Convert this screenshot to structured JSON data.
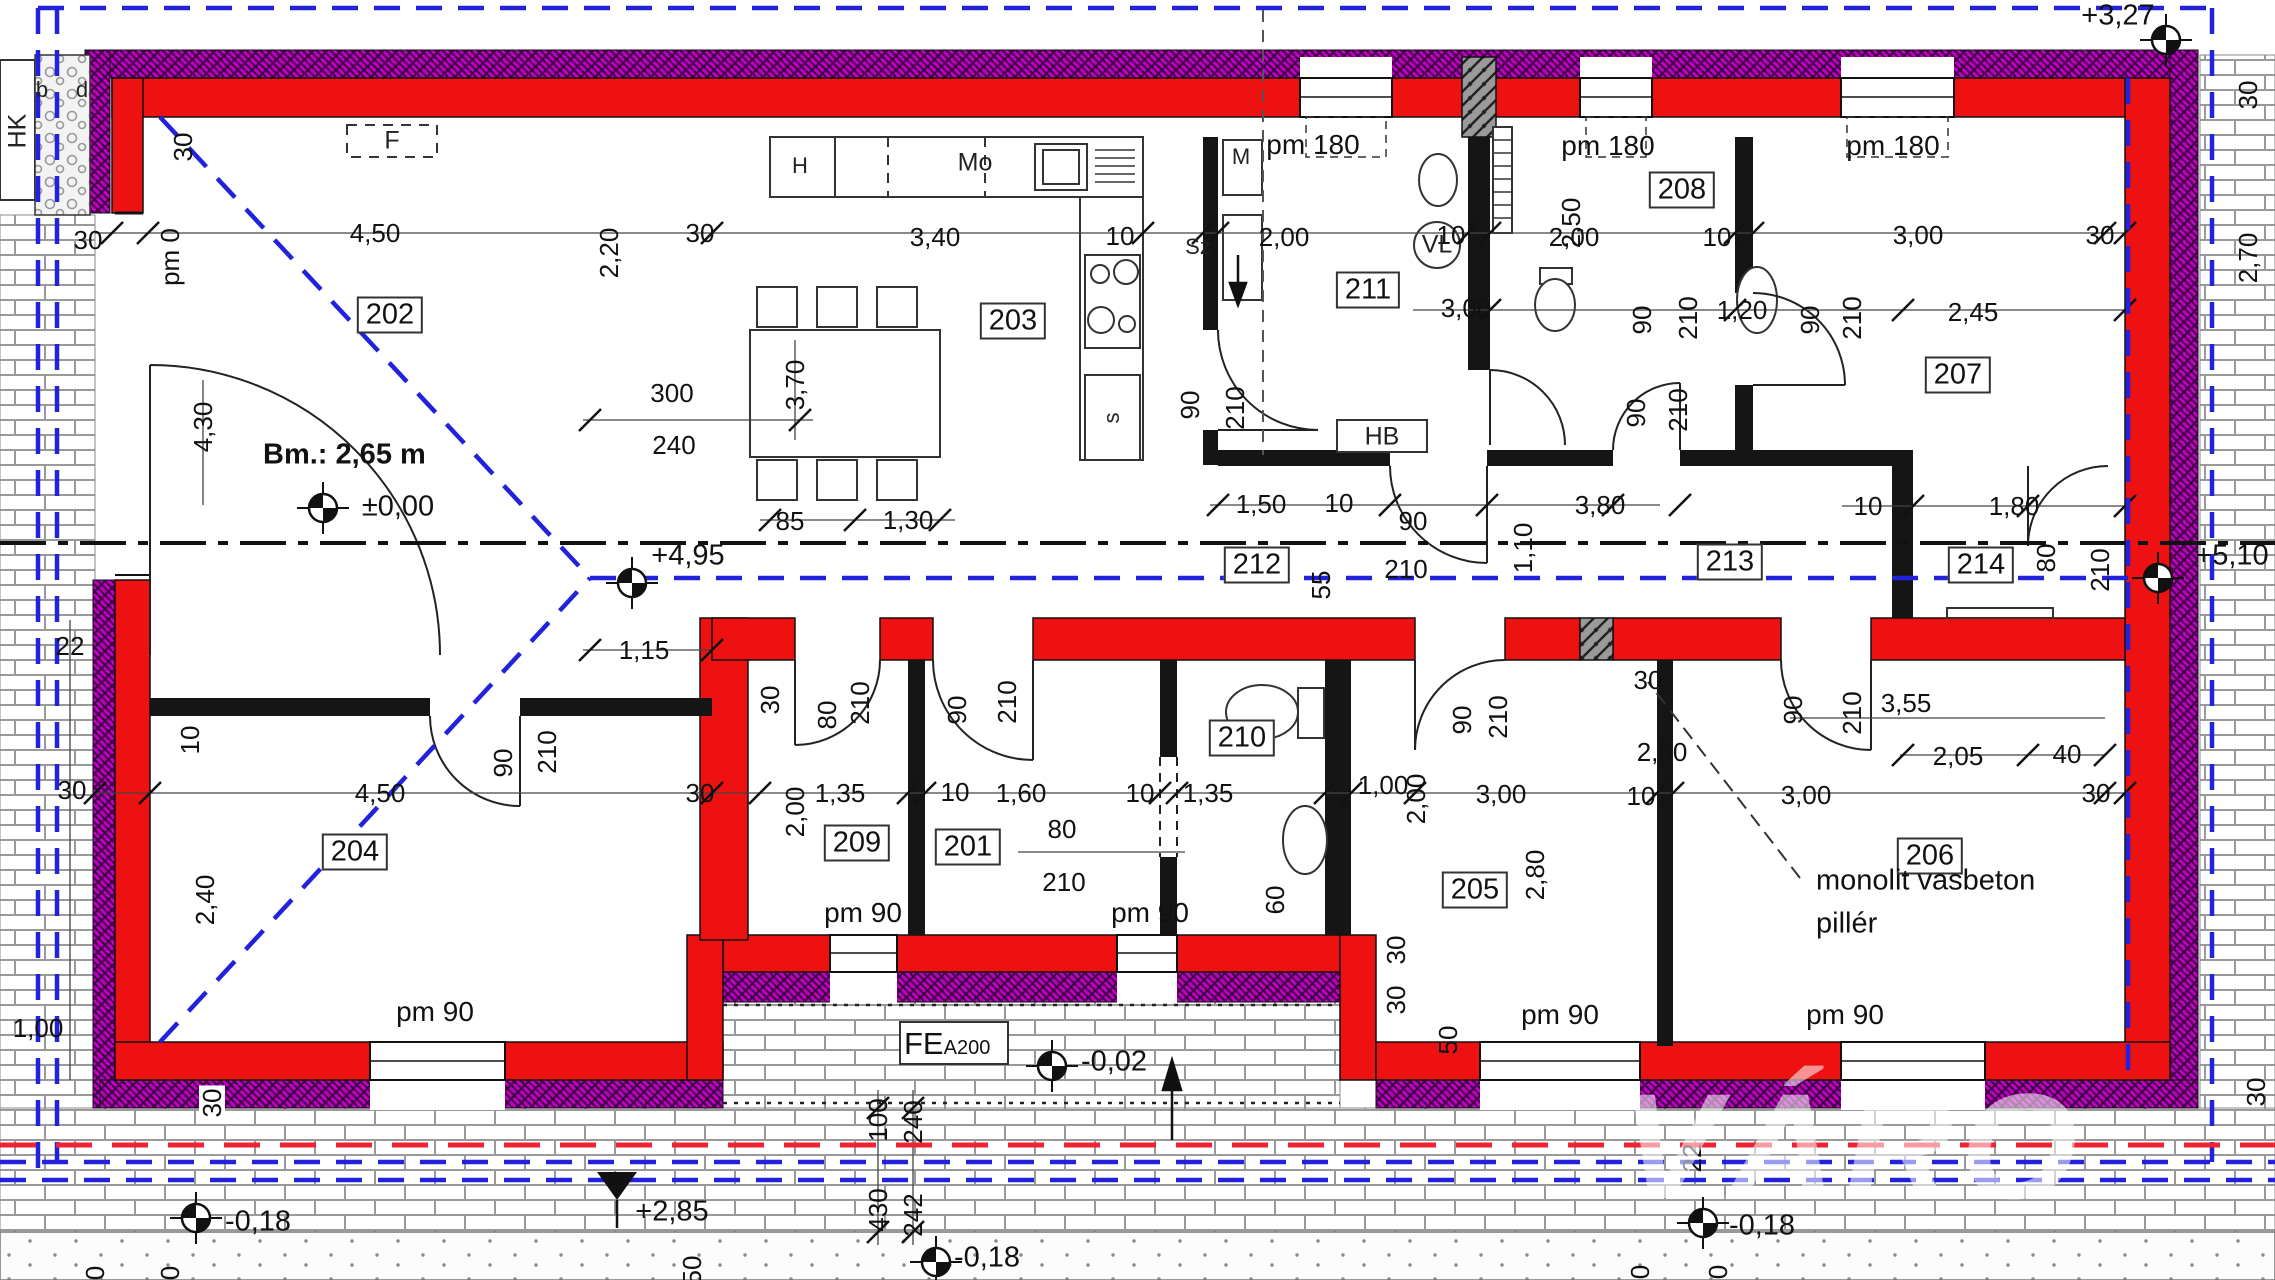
{
  "colors": {
    "wall_red": "#ee1111",
    "insulation_magenta": "#c000c4",
    "roof_line_blue": "#2222dd",
    "frost_line_red": "#ee2233",
    "pillar_grey": "#9a9a9a"
  },
  "rooms": [
    {
      "n": "202",
      "x": 390,
      "y": 315
    },
    {
      "n": "203",
      "x": 1013,
      "y": 321
    },
    {
      "n": "211",
      "x": 1368,
      "y": 290
    },
    {
      "n": "208",
      "x": 1682,
      "y": 190
    },
    {
      "n": "207",
      "x": 1958,
      "y": 375
    },
    {
      "n": "212",
      "x": 1257,
      "y": 565
    },
    {
      "n": "213",
      "x": 1730,
      "y": 562
    },
    {
      "n": "214",
      "x": 1981,
      "y": 565
    },
    {
      "n": "204",
      "x": 355,
      "y": 852
    },
    {
      "n": "209",
      "x": 857,
      "y": 843
    },
    {
      "n": "201",
      "x": 968,
      "y": 847
    },
    {
      "n": "210",
      "x": 1242,
      "y": 738
    },
    {
      "n": "205",
      "x": 1475,
      "y": 890
    },
    {
      "n": "206",
      "x": 1930,
      "y": 856
    }
  ],
  "dims": [
    {
      "t": "30",
      "x": 88,
      "y": 240
    },
    {
      "t": "30",
      "x": 183,
      "y": 147,
      "r": 1
    },
    {
      "t": "pm 0",
      "x": 170,
      "y": 257,
      "r": 1
    },
    {
      "t": "4,50",
      "x": 375,
      "y": 233
    },
    {
      "t": "30",
      "x": 700,
      "y": 233
    },
    {
      "t": "3,40",
      "x": 935,
      "y": 237
    },
    {
      "t": "10",
      "x": 1120,
      "y": 236
    },
    {
      "t": "2,00",
      "x": 1284,
      "y": 237
    },
    {
      "t": "10",
      "x": 1451,
      "y": 235
    },
    {
      "t": "2,00",
      "x": 1574,
      "y": 237
    },
    {
      "t": "10",
      "x": 1717,
      "y": 237
    },
    {
      "t": "3,00",
      "x": 1918,
      "y": 235
    },
    {
      "t": "30",
      "x": 2100,
      "y": 235
    },
    {
      "t": "2,20",
      "x": 609,
      "y": 253,
      "r": 1
    },
    {
      "t": "3,70",
      "x": 795,
      "y": 385,
      "r": 1
    },
    {
      "t": "300",
      "x": 672,
      "y": 393
    },
    {
      "t": "240",
      "x": 674,
      "y": 445
    },
    {
      "t": "4,30",
      "x": 203,
      "y": 427,
      "r": 1
    },
    {
      "t": "3,00",
      "x": 1466,
      "y": 308
    },
    {
      "t": "1,20",
      "x": 1742,
      "y": 310
    },
    {
      "t": "2,45",
      "x": 1973,
      "y": 312
    },
    {
      "t": "2,50",
      "x": 1571,
      "y": 223,
      "r": 1
    },
    {
      "t": "90",
      "x": 1190,
      "y": 405,
      "r": 1
    },
    {
      "t": "210",
      "x": 1235,
      "y": 408,
      "r": 1
    },
    {
      "t": "90",
      "x": 1642,
      "y": 320,
      "r": 1
    },
    {
      "t": "210",
      "x": 1688,
      "y": 318,
      "r": 1
    },
    {
      "t": "90",
      "x": 1810,
      "y": 320,
      "r": 1
    },
    {
      "t": "210",
      "x": 1852,
      "y": 318,
      "r": 1
    },
    {
      "t": "85",
      "x": 790,
      "y": 521
    },
    {
      "t": "1,30",
      "x": 908,
      "y": 520
    },
    {
      "t": "1,50",
      "x": 1261,
      "y": 504
    },
    {
      "t": "10",
      "x": 1339,
      "y": 503
    },
    {
      "t": "90",
      "x": 1413,
      "y": 521
    },
    {
      "t": "210",
      "x": 1406,
      "y": 569
    },
    {
      "t": "55",
      "x": 1321,
      "y": 585,
      "r": 1
    },
    {
      "t": "3,80",
      "x": 1600,
      "y": 505
    },
    {
      "t": "1,10",
      "x": 1523,
      "y": 548,
      "r": 1
    },
    {
      "t": "10",
      "x": 1868,
      "y": 506
    },
    {
      "t": "1,80",
      "x": 2014,
      "y": 506
    },
    {
      "t": "80",
      "x": 2046,
      "y": 558,
      "r": 1
    },
    {
      "t": "210",
      "x": 2100,
      "y": 570,
      "r": 1
    },
    {
      "t": "90",
      "x": 1636,
      "y": 413,
      "r": 1
    },
    {
      "t": "210",
      "x": 1678,
      "y": 410,
      "r": 1
    },
    {
      "t": "1,15",
      "x": 644,
      "y": 650
    },
    {
      "t": "30",
      "x": 770,
      "y": 700,
      "r": 1
    },
    {
      "t": "80",
      "x": 827,
      "y": 715,
      "r": 1
    },
    {
      "t": "210",
      "x": 860,
      "y": 703,
      "r": 1
    },
    {
      "t": "90",
      "x": 957,
      "y": 710,
      "r": 1
    },
    {
      "t": "210",
      "x": 1007,
      "y": 702,
      "r": 1
    },
    {
      "t": "22",
      "x": 70,
      "y": 646
    },
    {
      "t": "30",
      "x": 72,
      "y": 790
    },
    {
      "t": "10",
      "x": 190,
      "y": 740,
      "r": 1
    },
    {
      "t": "4,50",
      "x": 380,
      "y": 793
    },
    {
      "t": "30",
      "x": 700,
      "y": 793
    },
    {
      "t": "90",
      "x": 503,
      "y": 763,
      "r": 1
    },
    {
      "t": "210",
      "x": 547,
      "y": 752,
      "r": 1
    },
    {
      "t": "2,40",
      "x": 205,
      "y": 900,
      "r": 1
    },
    {
      "t": "1,00",
      "x": 38,
      "y": 1028
    },
    {
      "t": "2,00",
      "x": 795,
      "y": 812,
      "r": 1
    },
    {
      "t": "1,35",
      "x": 840,
      "y": 793
    },
    {
      "t": "10",
      "x": 955,
      "y": 792
    },
    {
      "t": "1,60",
      "x": 1021,
      "y": 793
    },
    {
      "t": "80",
      "x": 1062,
      "y": 829
    },
    {
      "t": "210",
      "x": 1064,
      "y": 882
    },
    {
      "t": "10",
      "x": 1140,
      "y": 793
    },
    {
      "t": "1,35",
      "x": 1208,
      "y": 793
    },
    {
      "t": "60",
      "x": 1275,
      "y": 900,
      "r": 1
    },
    {
      "t": "1,00",
      "x": 1383,
      "y": 785
    },
    {
      "t": "2,00",
      "x": 1416,
      "y": 799,
      "r": 1
    },
    {
      "t": "3,00",
      "x": 1501,
      "y": 794
    },
    {
      "t": "10",
      "x": 1641,
      "y": 796
    },
    {
      "t": "3,00",
      "x": 1806,
      "y": 795
    },
    {
      "t": "30",
      "x": 2096,
      "y": 793
    },
    {
      "t": "2,80",
      "x": 1535,
      "y": 875,
      "r": 1
    },
    {
      "t": "90",
      "x": 1462,
      "y": 720,
      "r": 1
    },
    {
      "t": "210",
      "x": 1498,
      "y": 717,
      "r": 1
    },
    {
      "t": "90",
      "x": 1793,
      "y": 710,
      "r": 1
    },
    {
      "t": "210",
      "x": 1852,
      "y": 713,
      "r": 1
    },
    {
      "t": "30",
      "x": 1648,
      "y": 680
    },
    {
      "t": "2,50",
      "x": 1662,
      "y": 752
    },
    {
      "t": "3,55",
      "x": 1906,
      "y": 703
    },
    {
      "t": "2,05",
      "x": 1958,
      "y": 756
    },
    {
      "t": "40",
      "x": 2067,
      "y": 754
    },
    {
      "t": "30",
      "x": 1396,
      "y": 950,
      "r": 1
    },
    {
      "t": "30",
      "x": 1396,
      "y": 1000,
      "r": 1
    },
    {
      "t": "50",
      "x": 1448,
      "y": 1040,
      "r": 1
    },
    {
      "t": "22",
      "x": 1692,
      "y": 1158,
      "r": 1
    },
    {
      "t": "30",
      "x": 212,
      "y": 1103,
      "r": 1,
      "cls": "boxed"
    },
    {
      "t": "100",
      "x": 878,
      "y": 1120,
      "r": 1
    },
    {
      "t": "240",
      "x": 913,
      "y": 1122,
      "r": 1
    },
    {
      "t": "430",
      "x": 878,
      "y": 1210,
      "r": 1
    },
    {
      "t": "242",
      "x": 913,
      "y": 1215,
      "r": 1
    },
    {
      "t": "0",
      "x": 95,
      "y": 1273,
      "r": 1
    },
    {
      "t": "0",
      "x": 170,
      "y": 1273,
      "r": 1
    },
    {
      "t": "50",
      "x": 692,
      "y": 1270,
      "r": 1
    },
    {
      "t": "0",
      "x": 1640,
      "y": 1272,
      "r": 1
    },
    {
      "t": "0",
      "x": 1718,
      "y": 1272,
      "r": 1
    },
    {
      "t": "30",
      "x": 2256,
      "y": 1092,
      "r": 1
    },
    {
      "t": "30",
      "x": 2248,
      "y": 95,
      "r": 1
    },
    {
      "t": "2,70",
      "x": 2248,
      "y": 258,
      "r": 1
    },
    {
      "t": "pm 180",
      "x": 1313,
      "y": 145,
      "cls": "pm"
    },
    {
      "t": "pm 180",
      "x": 1608,
      "y": 146,
      "cls": "pm"
    },
    {
      "t": "pm 180",
      "x": 1893,
      "y": 146,
      "cls": "pm"
    },
    {
      "t": "pm 90",
      "x": 435,
      "y": 1012,
      "cls": "pm"
    },
    {
      "t": "pm 90",
      "x": 863,
      "y": 913,
      "cls": "pm"
    },
    {
      "t": "pm 90",
      "x": 1150,
      "y": 913,
      "cls": "pm"
    },
    {
      "t": "pm 90",
      "x": 1560,
      "y": 1015,
      "cls": "pm"
    },
    {
      "t": "pm 90",
      "x": 1845,
      "y": 1015,
      "cls": "pm"
    }
  ],
  "fixtures": [
    {
      "t": "H",
      "x": 800,
      "y": 166
    },
    {
      "t": "Mo",
      "x": 975,
      "y": 163,
      "cls": "big"
    },
    {
      "t": "M",
      "x": 1241,
      "y": 157
    },
    {
      "t": "Sz",
      "x": 1198,
      "y": 247
    },
    {
      "t": "s",
      "x": 1112,
      "y": 418,
      "r": 1
    },
    {
      "t": "VL",
      "x": 1437,
      "y": 245,
      "cls": "big"
    },
    {
      "t": "HB",
      "x": 1382,
      "y": 437,
      "cls": "big"
    },
    {
      "t": "HK",
      "x": 18,
      "y": 131,
      "r": 1,
      "cls": "big"
    },
    {
      "t": "F",
      "x": 392,
      "y": 141,
      "cls": "big"
    },
    {
      "t": "b",
      "x": 42,
      "y": 90
    },
    {
      "t": "d",
      "x": 82,
      "y": 90
    }
  ],
  "levels": [
    {
      "t": "±0,00",
      "x": 398,
      "y": 507,
      "mx": 323,
      "my": 508,
      "sym": "t"
    },
    {
      "t": "+4,95",
      "x": 688,
      "y": 556,
      "mx": 632,
      "my": 583,
      "sym": "t"
    },
    {
      "t": "+5,10",
      "x": 2232,
      "y": 556,
      "mx": 2158,
      "my": 578,
      "sym": "t"
    },
    {
      "t": "+3,27",
      "x": 2118,
      "y": 16,
      "mx": 2166,
      "my": 40,
      "sym": "t"
    },
    {
      "t": "-0,02",
      "x": 1114,
      "y": 1062,
      "mx": 1052,
      "my": 1066,
      "sym": "t"
    },
    {
      "t": "+2,85",
      "x": 672,
      "y": 1212,
      "mx": 617,
      "my": 1186,
      "sym": "tri"
    },
    {
      "t": "-0,18",
      "x": 258,
      "y": 1222,
      "mx": 196,
      "my": 1218,
      "sym": "t"
    },
    {
      "t": "-0,18",
      "x": 987,
      "y": 1258,
      "mx": 936,
      "my": 1262,
      "sym": "t"
    },
    {
      "t": "-0,18",
      "x": 1762,
      "y": 1226,
      "mx": 1703,
      "my": 1223,
      "sym": "t"
    }
  ],
  "notes": {
    "bm": "Bm.: 2,65 m",
    "pillar_line1": "monolit vasbeton",
    "pillar_line2": "pillér",
    "fe_main": "FE",
    "fe_sub": "A200"
  },
  "watermark": "VÁRO"
}
